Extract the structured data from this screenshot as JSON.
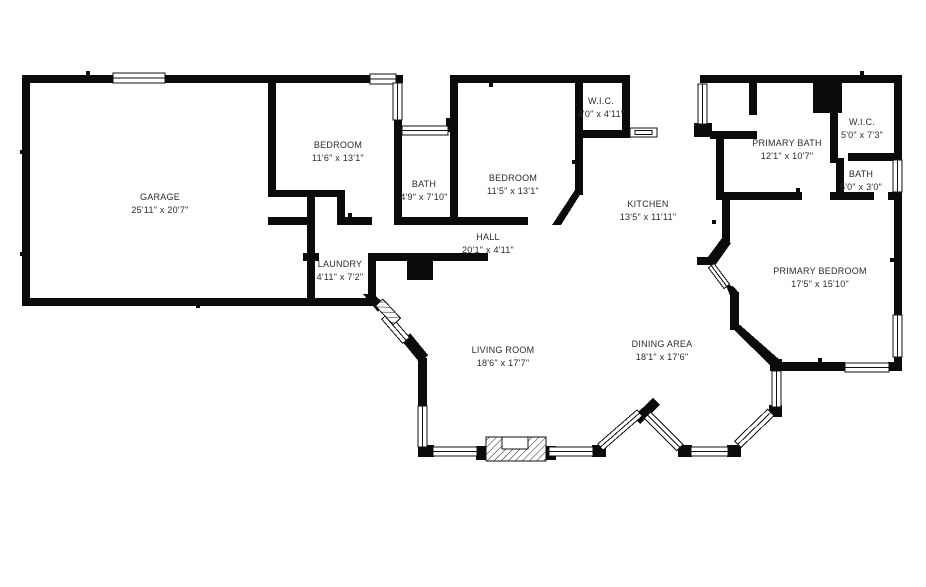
{
  "page": {
    "background": "#ffffff",
    "wall_color": "#0b0b0b",
    "label_color": "#2b2b2b"
  },
  "floorplan": {
    "rooms": [
      {
        "id": "garage",
        "name": "GARAGE",
        "dims": "25'11\" x 20'7\""
      },
      {
        "id": "bedroom-1",
        "name": "BEDROOM",
        "dims": "11'6\" x 13'1\""
      },
      {
        "id": "bath-1",
        "name": "BATH",
        "dims": "4'9\" x 7'10\""
      },
      {
        "id": "bedroom-2",
        "name": "BEDROOM",
        "dims": "11'5\" x 13'1\""
      },
      {
        "id": "wic-1",
        "name": "W.I.C.",
        "dims": "4'0\" x 4'11\""
      },
      {
        "id": "kitchen",
        "name": "KITCHEN",
        "dims": "13'5\" x 11'11\""
      },
      {
        "id": "hall",
        "name": "HALL",
        "dims": "20'1\" x 4'11\""
      },
      {
        "id": "laundry",
        "name": "LAUNDRY",
        "dims": "4'11\" x 7'2\""
      },
      {
        "id": "primary-bath",
        "name": "PRIMARY BATH",
        "dims": "12'1\" x 10'7\""
      },
      {
        "id": "wic-2",
        "name": "W.I.C.",
        "dims": "5'0\" x 7'3\""
      },
      {
        "id": "bath-2",
        "name": "BATH",
        "dims": "5'0\" x 3'0\""
      },
      {
        "id": "primary-bedroom",
        "name": "PRIMARY BEDROOM",
        "dims": "17'5\" x 15'10\""
      },
      {
        "id": "living-room",
        "name": "LIVING ROOM",
        "dims": "18'6\" x 17'7\""
      },
      {
        "id": "dining-area",
        "name": "DINING AREA",
        "dims": "18'1\" x 17'6\""
      }
    ]
  }
}
